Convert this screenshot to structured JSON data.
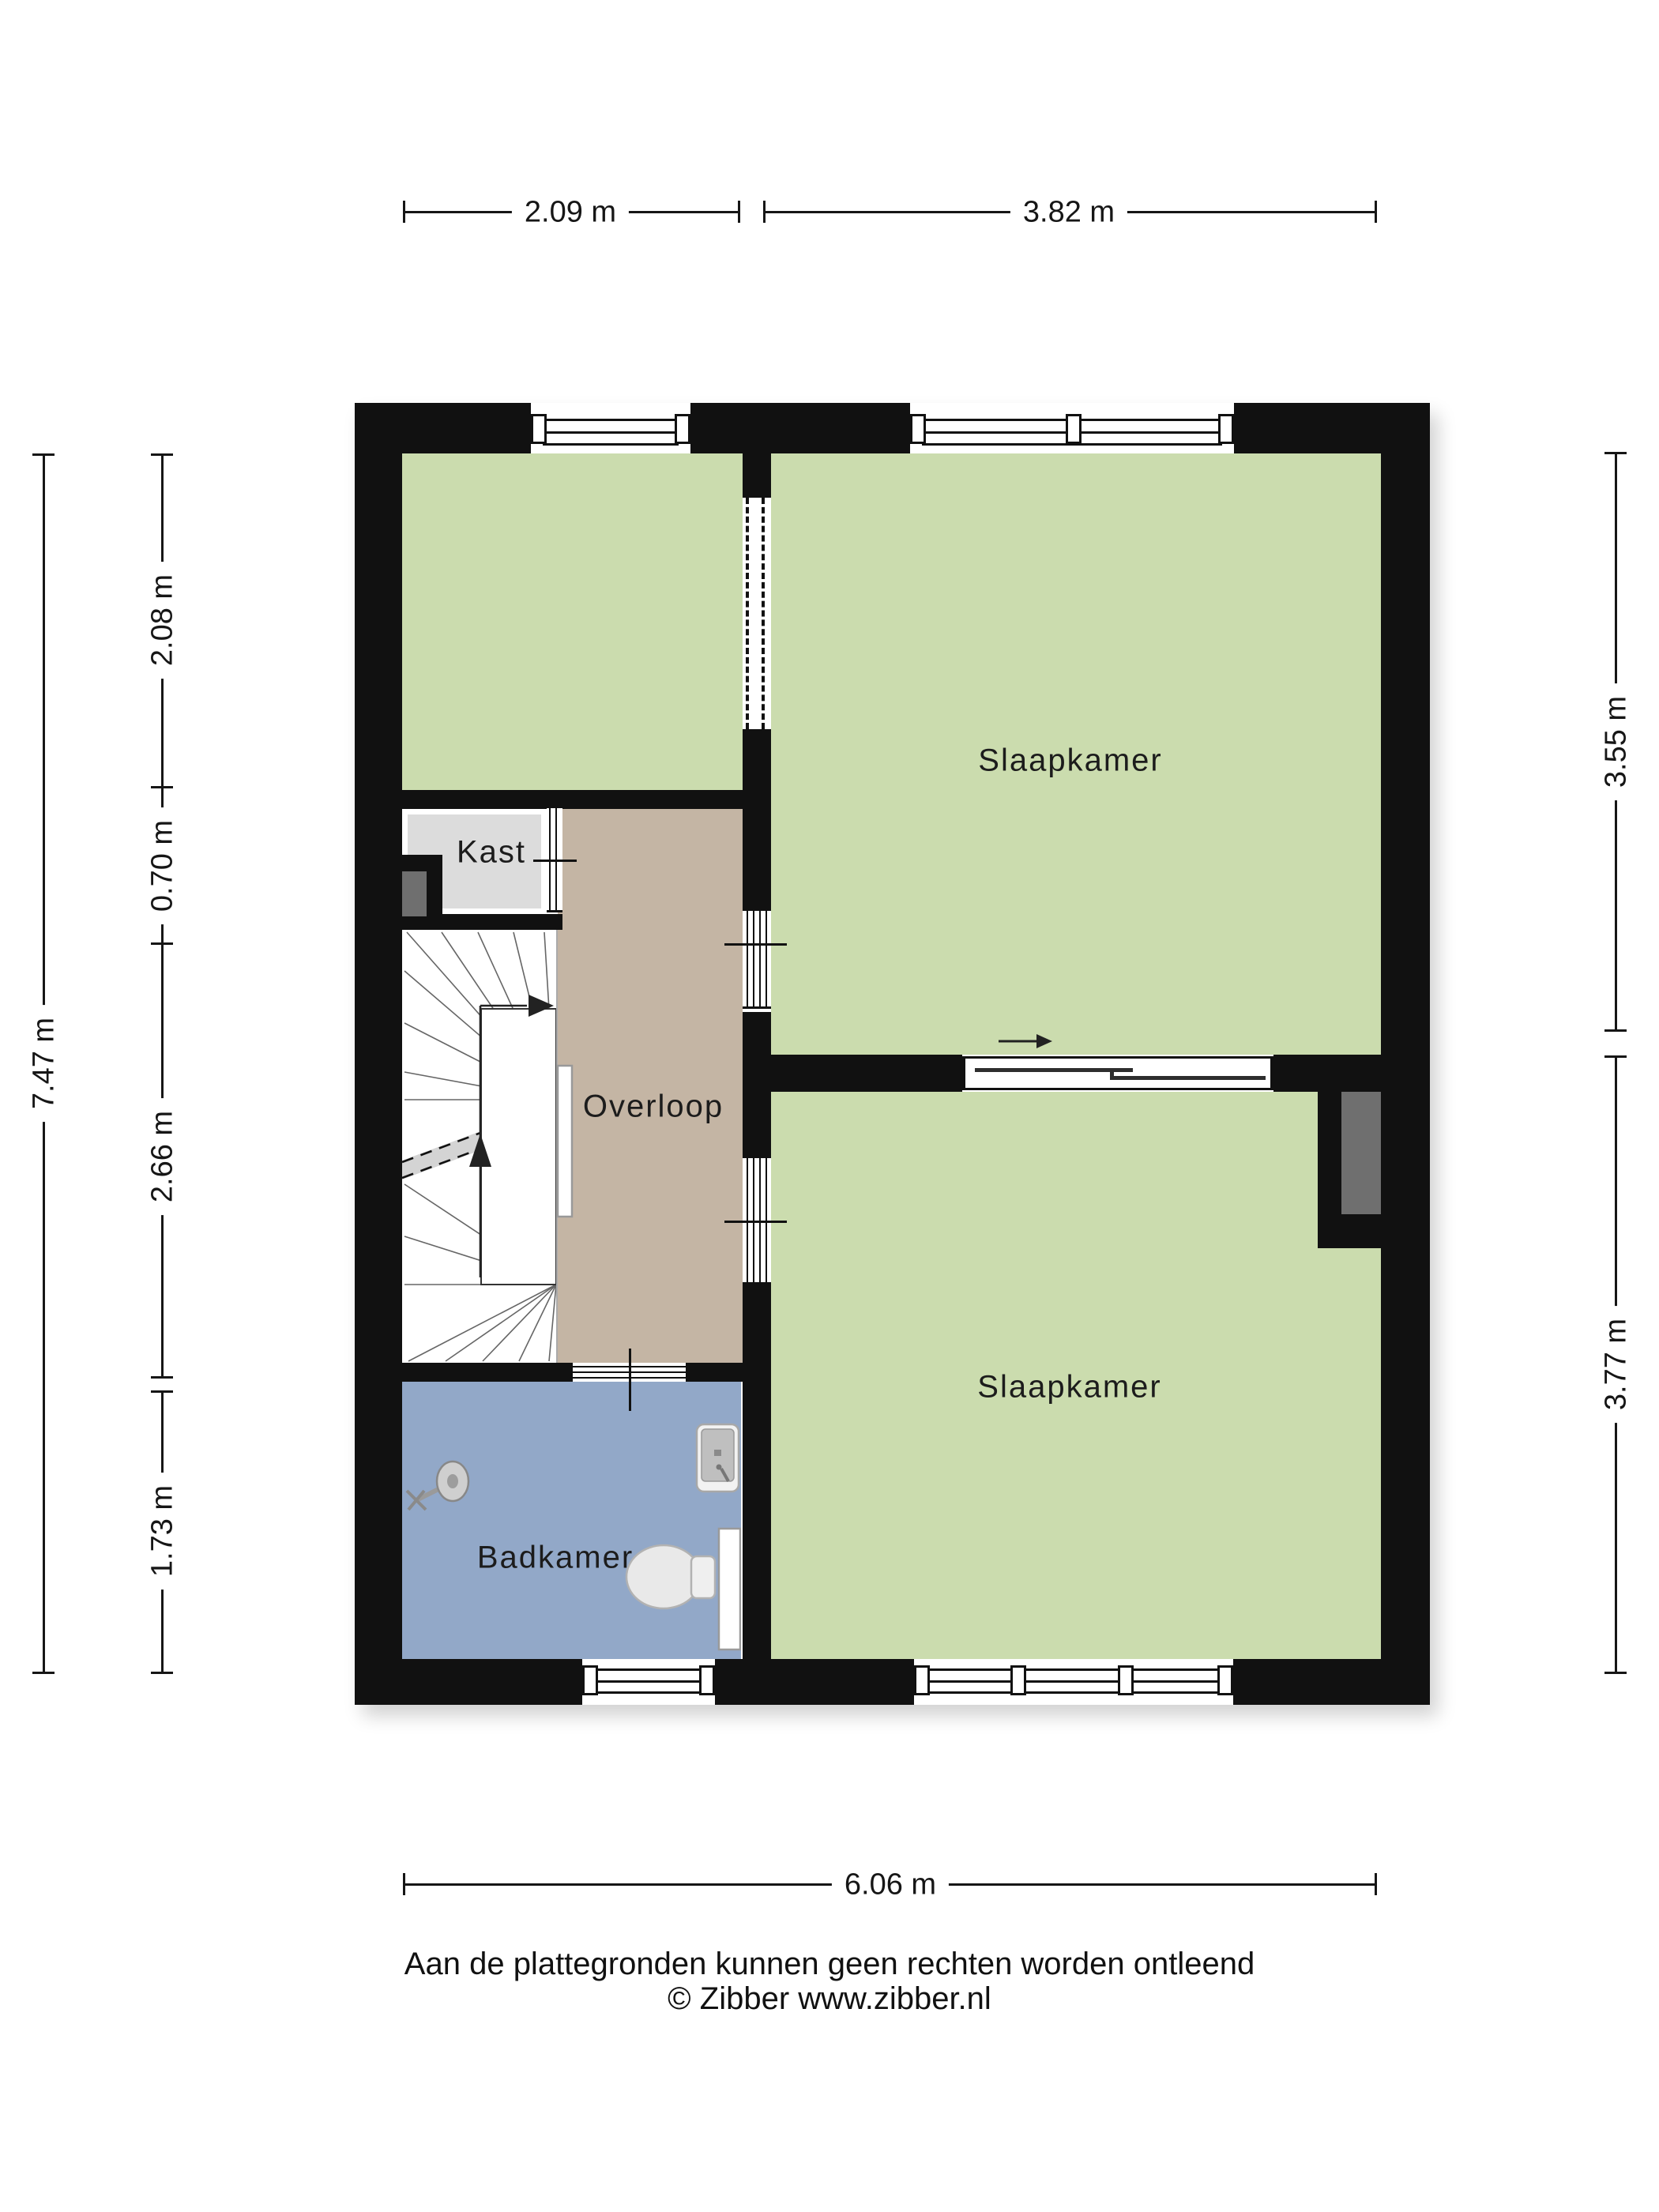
{
  "plan": {
    "type": "floorplan",
    "rooms": {
      "slaapkamer_top": {
        "label": "Slaapkamer"
      },
      "slaapkamer_bottom": {
        "label": "Slaapkamer"
      },
      "overloop": {
        "label": "Overloop"
      },
      "kast": {
        "label": "Kast"
      },
      "badkamer": {
        "label": "Badkamer"
      }
    },
    "colors": {
      "bedroom_green": "#cbdcae",
      "bathroom_blue": "#92a8c8",
      "hallway_tan": "#c4b5a4",
      "closet_gray": "#dcdcdc",
      "wall_black": "#111111",
      "shaft_gray": "#6f6f6f"
    },
    "icons": {
      "shower": "shower-head-icon",
      "sink": "washbasin-icon",
      "toilet": "toilet-icon",
      "stairs": "winder-staircase-icon",
      "sliding_door_arrow": "right-arrow-icon"
    }
  },
  "dimensions": {
    "top": {
      "seg1": "2.09 m",
      "seg2": "3.82 m"
    },
    "bottom": {
      "total": "6.06 m"
    },
    "left": {
      "total": "7.47 m",
      "seg1": "2.08 m",
      "seg2": "0.70 m",
      "seg3": "2.66 m",
      "seg4": "1.73 m"
    },
    "right": {
      "seg1": "3.55 m",
      "seg2": "3.77 m"
    }
  },
  "footer": {
    "disclaimer": "Aan de plattegronden kunnen geen rechten worden ontleend",
    "copyright": "© Zibber www.zibber.nl"
  }
}
